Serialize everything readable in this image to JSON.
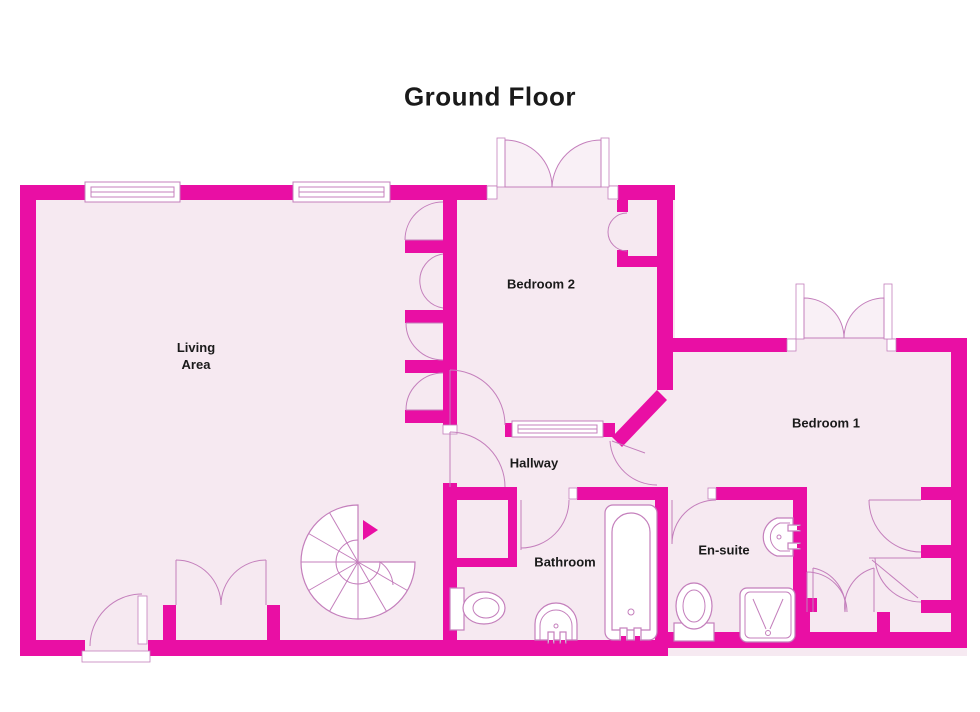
{
  "title": "Ground Floor",
  "rooms": {
    "living_area": {
      "label": "Living\nArea"
    },
    "bedroom2": {
      "label": "Bedroom 2"
    },
    "bedroom1": {
      "label": "Bedroom 1"
    },
    "hallway": {
      "label": "Hallway"
    },
    "bathroom": {
      "label": "Bathroom"
    },
    "ensuite": {
      "label": "En-suite"
    }
  },
  "colors": {
    "wall": "#E90FA4",
    "floor": "#F6E9F1",
    "line": "#C47FBC",
    "text": "#1A1A1A",
    "background": "#FFFFFF"
  }
}
